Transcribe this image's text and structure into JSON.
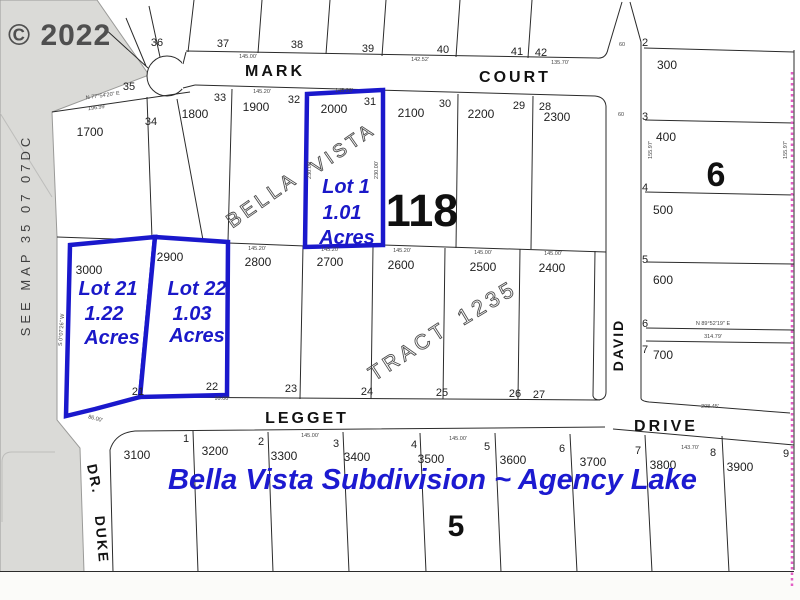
{
  "watermark": "© 2022",
  "margin_note": "SEE MAP 35 07 07DC",
  "title": "Bella Vista Subdivision ~ Agency Lake",
  "map_number": "118",
  "block_numbers": {
    "east": "6",
    "south": "5"
  },
  "streets": {
    "mark": "MARK",
    "court": "COURT",
    "legget": "LEGGET",
    "drive": "DRIVE",
    "david": "DAVID",
    "duke": "DUKE",
    "duke_suffix": "DR."
  },
  "plat_words": {
    "bella": "BELLA",
    "vista": "VISTA",
    "tract": "TRACT",
    "tract_number": "1235"
  },
  "highlighted": {
    "lot1": {
      "name": "Lot 1",
      "acres": "1.01",
      "acres_label": "Acres",
      "tax": "2000",
      "number": "31"
    },
    "lot21": {
      "name": "Lot 21",
      "acres": "1.22",
      "acres_label": "Acres"
    },
    "lot22": {
      "name": "Lot 22",
      "acres": "1.03",
      "acres_label": "Acres"
    }
  },
  "rows": {
    "top": [
      "36",
      "37",
      "38",
      "39",
      "40",
      "41",
      "42"
    ],
    "row2_numbers": [
      "35",
      "34",
      "33",
      "32",
      "30",
      "29",
      "28"
    ],
    "row2_tax": [
      "1700",
      "1800",
      "1900",
      "2100",
      "2200",
      "2300"
    ],
    "mid_numbers": [
      "21",
      "22",
      "23",
      "24",
      "25",
      "26",
      "27"
    ],
    "mid_tax": [
      "3000",
      "2900",
      "2800",
      "2700",
      "2600",
      "2500",
      "2400"
    ],
    "bottom_numbers": [
      "1",
      "2",
      "3",
      "4",
      "5",
      "6",
      "7",
      "8",
      "9"
    ],
    "bottom_tax": [
      "3100",
      "3200",
      "3300",
      "3400",
      "3500",
      "3600",
      "3700",
      "3800",
      "3900"
    ],
    "east_numbers": [
      "2",
      "3",
      "4",
      "5",
      "6",
      "7"
    ],
    "east_tax": [
      "300",
      "400",
      "500",
      "600",
      "700"
    ]
  },
  "dims": [
    "145.20'",
    "145.20'",
    "145.00'",
    "142.52'",
    "135.70'",
    "N 77°54'20\" E",
    "196.99'",
    "145.20'",
    "145.20'",
    "145.20'",
    "145.00'",
    "145.00'",
    "145.00'",
    "145.00'",
    "143.70'",
    "208.45'",
    "N 89°52'19\" E",
    "314.79'",
    "60",
    "60",
    "155.97'",
    "155.97'",
    "230.00'",
    "230.00'",
    "99.00'",
    "86.00'",
    "S 0°07'26\" W"
  ],
  "colors": {
    "highlight": "#1a18cc",
    "title_blue": "#1c1ad0",
    "magenta": "#e35fc5",
    "margin_gray": "#dadad7"
  }
}
